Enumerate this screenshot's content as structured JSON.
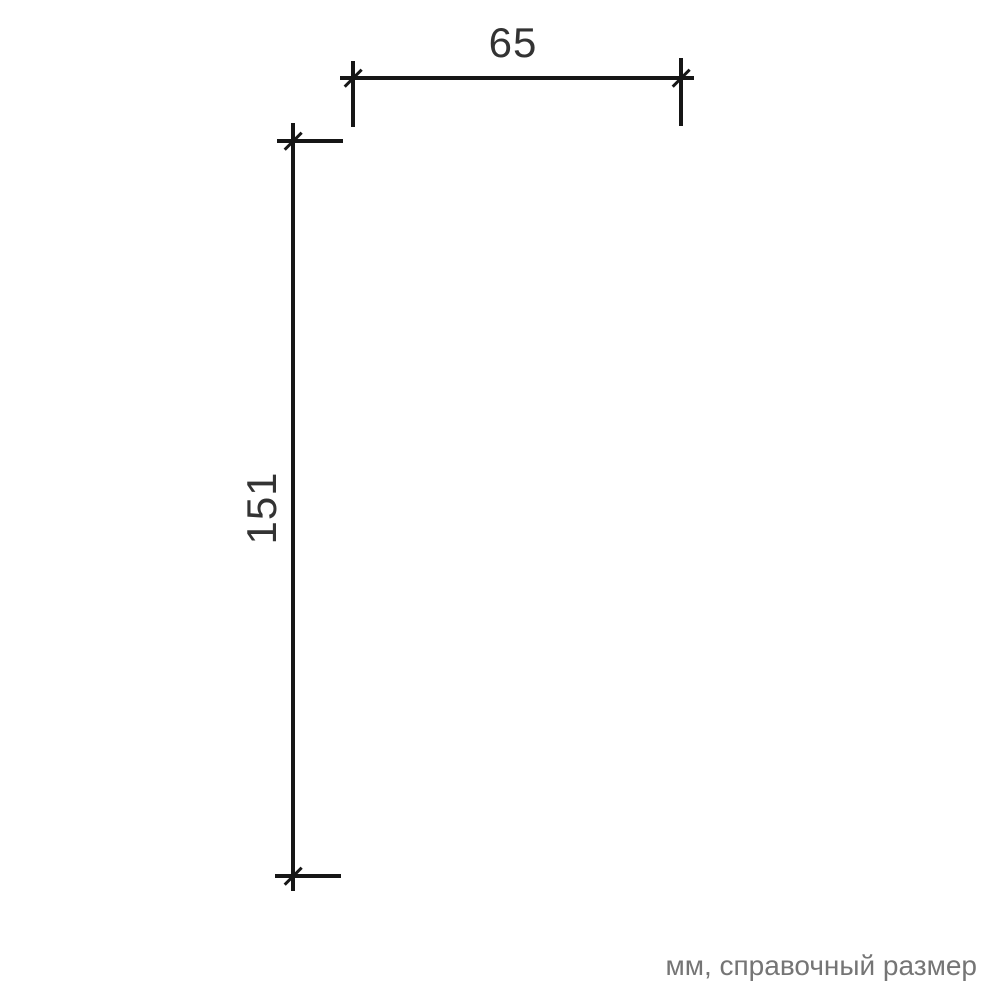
{
  "drawing": {
    "type": "dimension-diagram",
    "unit_note": "мм, справочный размер",
    "dimensions": [
      {
        "label": "65",
        "orientation": "horizontal",
        "value_mm": 65
      },
      {
        "label": "151",
        "orientation": "vertical",
        "value_mm": 151
      }
    ],
    "colors": {
      "line": "#161616",
      "dim_text": "#333333",
      "note_text": "#757575",
      "background": "#ffffff"
    }
  }
}
